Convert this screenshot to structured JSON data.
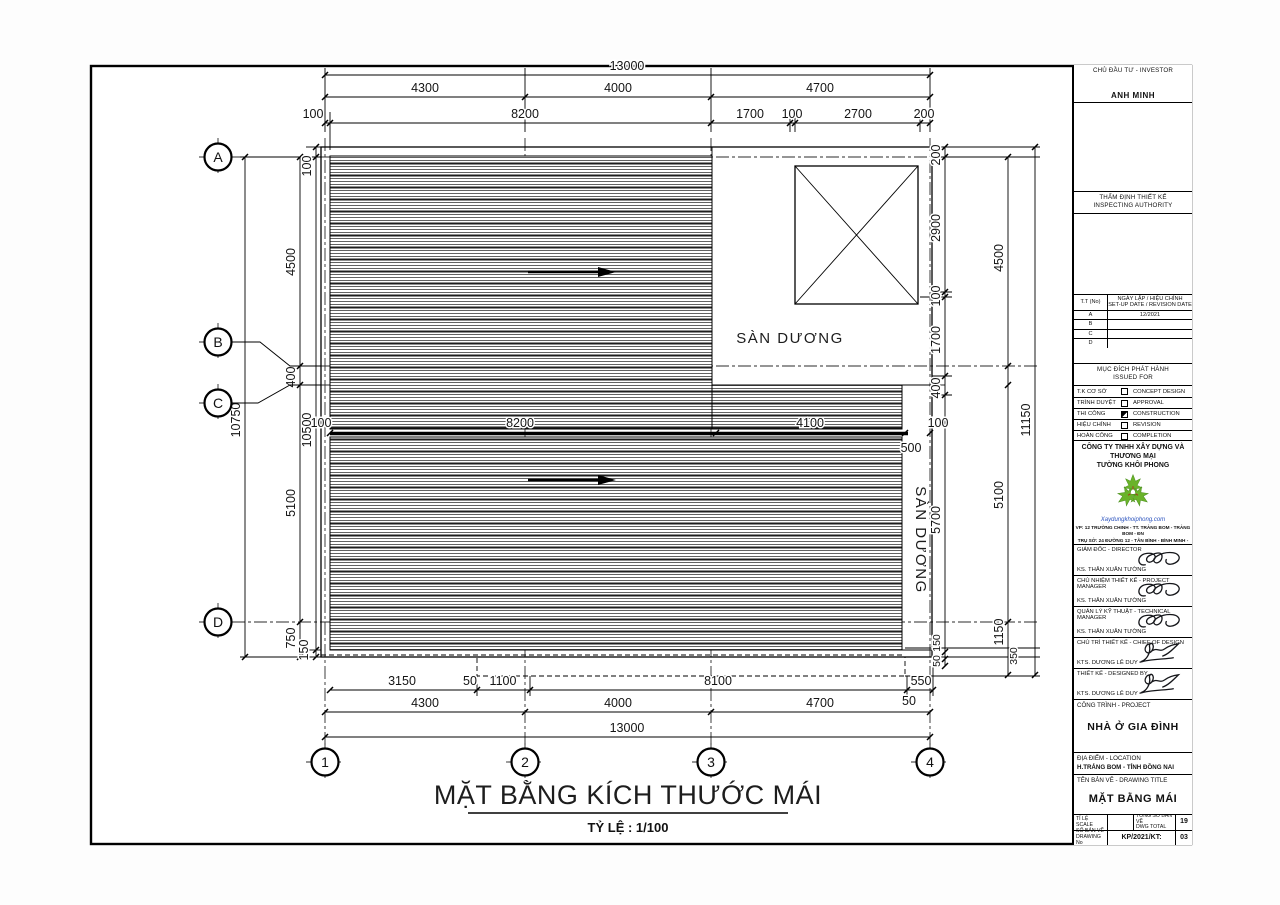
{
  "drawing": {
    "plan_title": "MẶT BẰNG KÍCH THƯỚC MÁI",
    "plan_scale": "TỶ LỆ : 1/100",
    "labels": {
      "terrace_top": "SÀN DƯƠNG",
      "terrace_right": "SÀN DƯƠNG"
    },
    "grid_rows": [
      "A",
      "B",
      "C",
      "D"
    ],
    "grid_cols": [
      "1",
      "2",
      "3",
      "4"
    ],
    "dims": {
      "top": {
        "overall": "13000",
        "row2": [
          "4300",
          "4000",
          "4700"
        ],
        "row3": [
          "100",
          "8200",
          "1700",
          "100",
          "2700",
          "200"
        ]
      },
      "middle": {
        "row": [
          "100",
          "8200",
          "4100",
          "100"
        ],
        "strip_width": "500"
      },
      "bottom": {
        "row1": [
          "3150",
          "50",
          "1100",
          "8100",
          "550"
        ],
        "extra": "50",
        "row2": [
          "4300",
          "4000",
          "4700"
        ],
        "overall": "13000"
      },
      "left": {
        "overall": "10750",
        "chain": [
          "4500",
          "400",
          "5100",
          "750"
        ],
        "inner": [
          "100",
          "10500",
          "150"
        ]
      },
      "right": {
        "overall": "11150",
        "chain": [
          "200",
          "2900",
          "100",
          "1700",
          "400",
          "5700",
          "150",
          "50"
        ],
        "mid": [
          "4500",
          "5100",
          "1150",
          "350"
        ]
      }
    }
  },
  "titleblock": {
    "investor_label": "CHỦ ĐẦU TƯ - INVESTOR",
    "investor_name": "ANH MINH",
    "inspect_label1": "THẨM ĐỊNH THIẾT KẾ",
    "inspect_label2": "INSPECTING AUTHORITY",
    "rev_table": {
      "col_no": "T.T (No)",
      "col_date1": "NGÀY LẬP / HIỆU CHỈNH",
      "col_date2": "SET-UP DATE / REVISION DATE",
      "rows": [
        {
          "no": "A",
          "date": "12/2021"
        },
        {
          "no": "B",
          "date": ""
        },
        {
          "no": "C",
          "date": ""
        },
        {
          "no": "D",
          "date": ""
        }
      ]
    },
    "issued": {
      "label1": "MỤC ĐÍCH PHÁT HÀNH",
      "label2": "ISSUED FOR",
      "rows": [
        {
          "vn": "T.K CƠ SỞ",
          "en": "CONCEPT DESIGN",
          "checked": false
        },
        {
          "vn": "TRÌNH DUYỆT",
          "en": "APPROVAL",
          "checked": false
        },
        {
          "vn": "THI CÔNG",
          "en": "CONSTRUCTION",
          "checked": true
        },
        {
          "vn": "HIỆU CHỈNH",
          "en": "REVISION",
          "checked": false
        },
        {
          "vn": "HOÀN CÔNG",
          "en": "COMPLETION",
          "checked": false
        }
      ]
    },
    "company": {
      "name1": "CÔNG TY TNHH XÂY DỰNG VÀ THƯƠNG MẠI",
      "name2": "TƯỜNG KHÔI PHONG",
      "website": "Xaydungkhoiphong.com",
      "addr1": "VP: 12 TRƯỜNG CHINH - TT. TRẢNG BOM - TRẢNG BOM - ĐN",
      "addr2": "TRỤ SỞ: 24 ĐƯỜNG 12 - TÂN BÌNH - BÌNH MINH - TRẢNG BOM - ĐN",
      "addr3": "Tel: 090x.xxx.xxx - 090x.xxx.xxx",
      "addr4": "Mail: xaydungkhoiphong@gmail.com"
    },
    "signers": [
      {
        "role": "GIÁM ĐỐC - DIRECTOR",
        "name": "KS. THÂN XUÂN TƯỜNG"
      },
      {
        "role": "CHỦ NHIỆM THIẾT KẾ - PROJECT MANAGER",
        "name": "KS. THÂN XUÂN TƯỜNG"
      },
      {
        "role": "QUẢN LÝ KỸ THUẬT - TECHNICAL MANAGER",
        "name": "KS. THÂN XUÂN TƯỜNG"
      },
      {
        "role": "CHỦ TRÌ THIẾT KẾ - CHIEF OF DESIGN",
        "name": "KTS. DƯƠNG LÊ DUY"
      },
      {
        "role": "THIẾT KẾ - DESIGNED BY",
        "name": "KTS. DƯƠNG LÊ DUY"
      }
    ],
    "project": {
      "label": "CÔNG TRÌNH - PROJECT",
      "name": "NHÀ Ở GIA ĐÌNH"
    },
    "location": {
      "label": "ĐỊA ĐIỂM - LOCATION",
      "value": "H.TRẢNG BOM - TỈNH ĐỒNG NAI"
    },
    "dwg_title": {
      "label": "TÊN BẢN VẼ - DRAWING TITLE",
      "value": "MẶT BẰNG MÁI"
    },
    "footer": {
      "scale_label1": "TỈ LỆ",
      "scale_label2": "SCALE",
      "scale_value": "",
      "total_label1": "TỔNG SỐ BẢN VẼ",
      "total_label2": "DWG TOTAL",
      "total_value": "19",
      "no_label1": "SỐ BẢN VẼ",
      "no_label2": "DRAWING No",
      "no_value": "KP/2021/KT:",
      "no_seq": "03"
    },
    "logo_color": "#6ab32a"
  }
}
